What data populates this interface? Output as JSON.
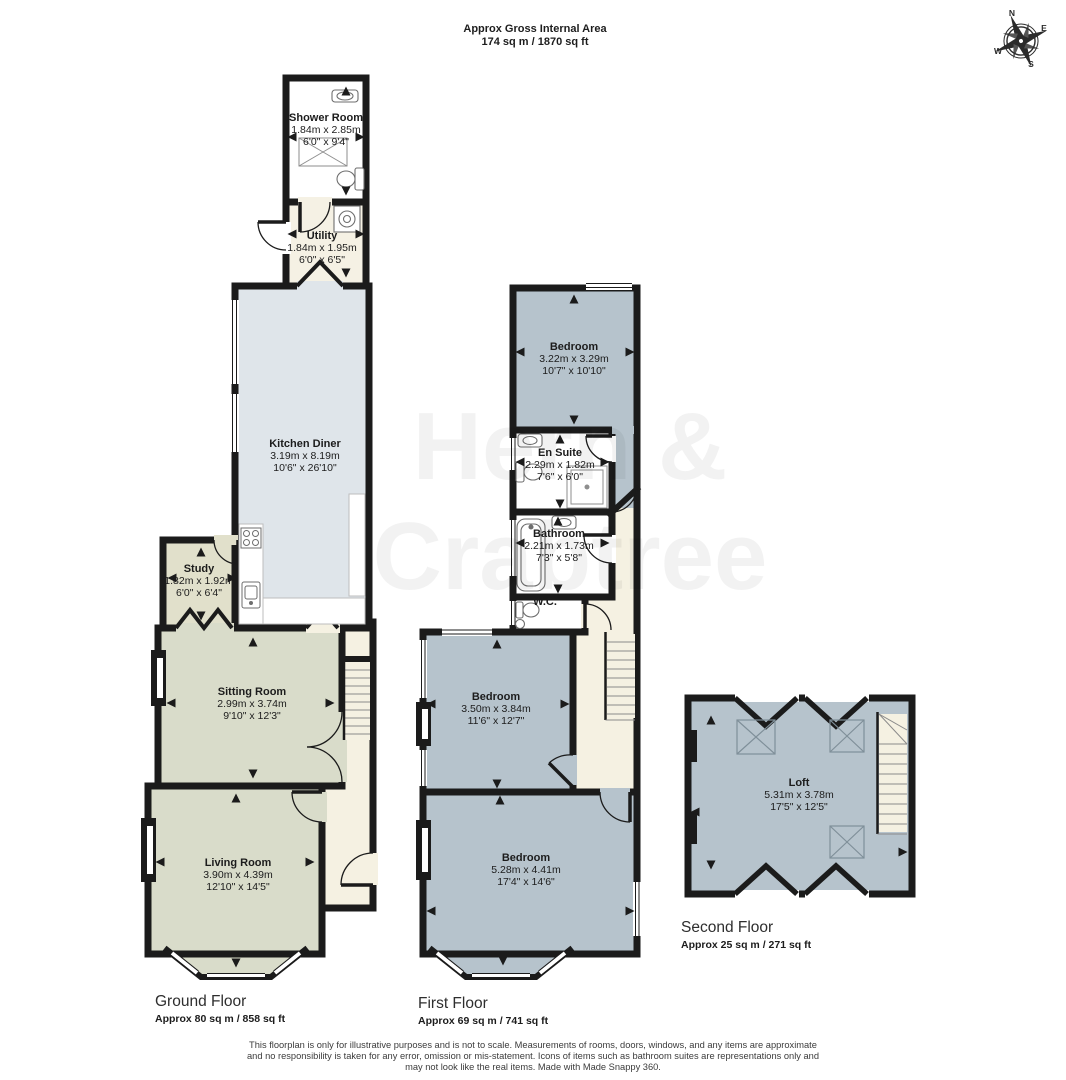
{
  "title": {
    "line1": "Approx Gross Internal Area",
    "line2": "174 sq m / 1870 sq ft"
  },
  "compass": {
    "n": "N",
    "e": "E",
    "s": "S",
    "w": "W"
  },
  "watermark": {
    "line1": "Hern &",
    "line2": "Crabtree"
  },
  "floors": {
    "ground": {
      "name": "Ground Floor",
      "area": "Approx 80 sq m / 858 sq ft"
    },
    "first": {
      "name": "First Floor",
      "area": "Approx 69 sq m / 741 sq ft"
    },
    "second": {
      "name": "Second Floor",
      "area": "Approx 25 sq m / 271 sq ft"
    }
  },
  "rooms": {
    "shower_room": {
      "name": "Shower Room",
      "metric": "1.84m x 2.85m",
      "imperial": "6'0\" x 9'4\""
    },
    "utility": {
      "name": "Utility",
      "metric": "1.84m x 1.95m",
      "imperial": "6'0\" x 6'5\""
    },
    "kitchen_diner": {
      "name": "Kitchen Diner",
      "metric": "3.19m x 8.19m",
      "imperial": "10'6\" x 26'10\""
    },
    "study": {
      "name": "Study",
      "metric": "1.82m x 1.92m",
      "imperial": "6'0\" x 6'4\""
    },
    "sitting_room": {
      "name": "Sitting Room",
      "metric": "2.99m x 3.74m",
      "imperial": "9'10\" x 12'3\""
    },
    "living_room": {
      "name": "Living Room",
      "metric": "3.90m x 4.39m",
      "imperial": "12'10\" x 14'5\""
    },
    "bedroom_1": {
      "name": "Bedroom",
      "metric": "3.22m x 3.29m",
      "imperial": "10'7\" x 10'10\""
    },
    "en_suite": {
      "name": "En Suite",
      "metric": "2.29m x 1.82m",
      "imperial": "7'6\" x 6'0\""
    },
    "bathroom": {
      "name": "Bathroom",
      "metric": "2.21m x 1.73m",
      "imperial": "7'3\" x 5'8\""
    },
    "wc": {
      "name": "W.C."
    },
    "bedroom_2": {
      "name": "Bedroom",
      "metric": "3.50m x 3.84m",
      "imperial": "11'6\" x 12'7\""
    },
    "bedroom_3": {
      "name": "Bedroom",
      "metric": "5.28m x 4.41m",
      "imperial": "17'4\" x 14'6\""
    },
    "loft": {
      "name": "Loft",
      "metric": "5.31m x 3.78m",
      "imperial": "17'5\" x 12'5\""
    }
  },
  "footer": {
    "lines": [
      "This floorplan is only for illustrative purposes and is not to scale. Measurements of rooms, doors, windows, and any items are approximate",
      "and no responsibility is taken for any error, omission or mis-statement. Icons of items such as bathroom suites are representations only and",
      "may not look like the real items. Made with Made Snappy 360."
    ]
  },
  "colors": {
    "wall": "#1b1b1b",
    "kitchen_fill": "#dfe5ea",
    "lounge_fill": "#d9dcca",
    "study_fill": "#e1e0cb",
    "bedroom_fill": "#b6c3cc",
    "hall_fill": "#f5f1e2",
    "utility_fill": "#f5f1e4",
    "bathroom_fill": "#ffffff"
  }
}
